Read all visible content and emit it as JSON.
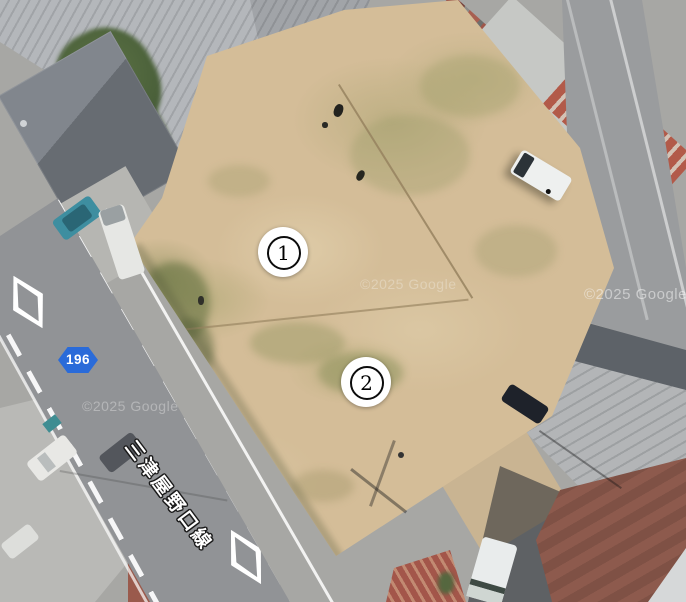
{
  "map": {
    "markers": [
      {
        "number": "1"
      },
      {
        "number": "2"
      }
    ],
    "route_badge": {
      "number": "196"
    },
    "road_label": {
      "text": "三津屋野口線"
    },
    "partial_road_label": {
      "text": "線"
    },
    "watermark": {
      "text": "©2025 Google"
    },
    "colors": {
      "lot_tan": "#d4bd98",
      "road_gray": "#919396",
      "badge_blue": "#2a6bd9",
      "roof_red": "#9e564a",
      "roof_gray": "#b3b5b7",
      "house_gray": "#6a6f75",
      "marker_white": "#ffffff"
    }
  }
}
